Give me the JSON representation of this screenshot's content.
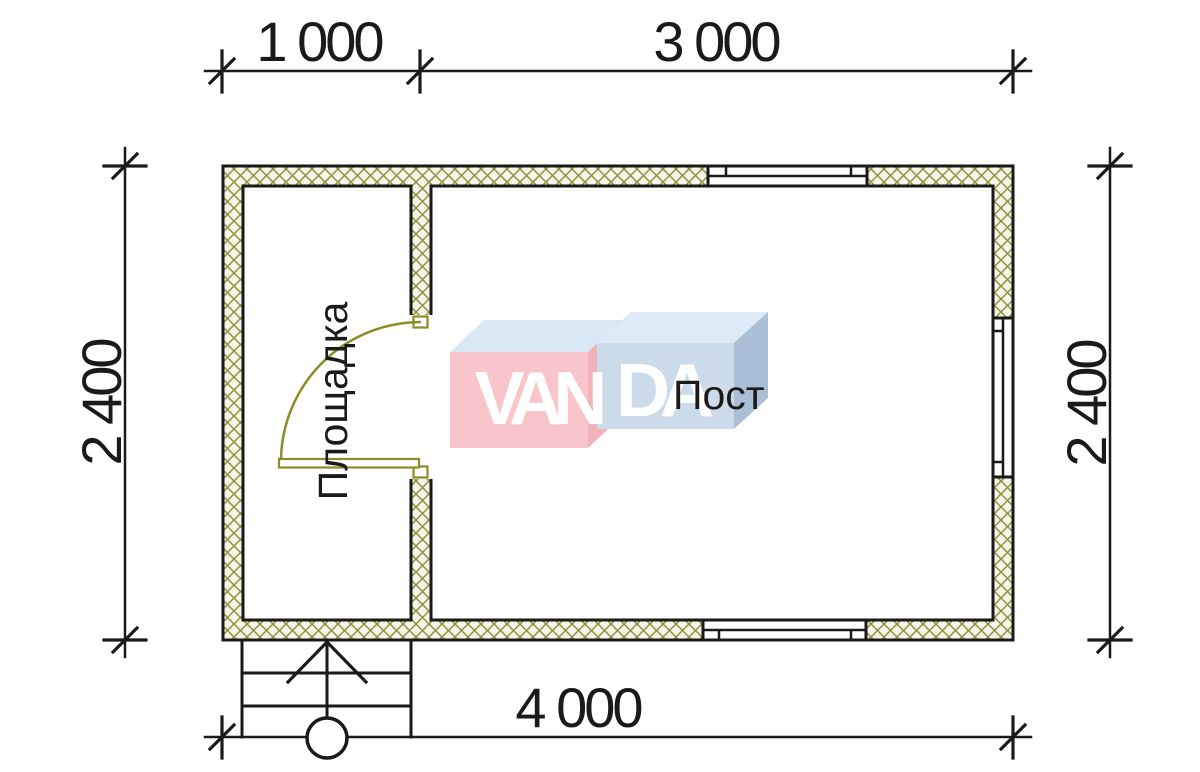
{
  "colors": {
    "line": "#1a1a1a",
    "text": "#1a1a1a",
    "hatch_bg": "#f6f6e8",
    "hatch_line": "#8f9140",
    "door": "#8c8c28",
    "white": "#ffffff",
    "logo_pink_front": "#f7c5ca",
    "logo_pink_side": "#f1b3ba",
    "logo_blue_front": "#cbdbea",
    "logo_blue_top_left": "#d9e8f5",
    "logo_blue_top_right": "#dcebf7",
    "logo_blue_side": "#aabfd5",
    "logo_letter": "#ffffff"
  },
  "dimensions": {
    "top": [
      {
        "label": "1 000"
      },
      {
        "label": "3 000"
      }
    ],
    "bottom": {
      "label": "4 000"
    },
    "left": {
      "label": "2 400"
    },
    "right": {
      "label": "2 400"
    }
  },
  "rooms": [
    {
      "label": "Площадка"
    },
    {
      "label": "Пост"
    }
  ],
  "watermark": {
    "brand": "VANDA",
    "left_letters": "VAN",
    "right_letters": "DA"
  }
}
